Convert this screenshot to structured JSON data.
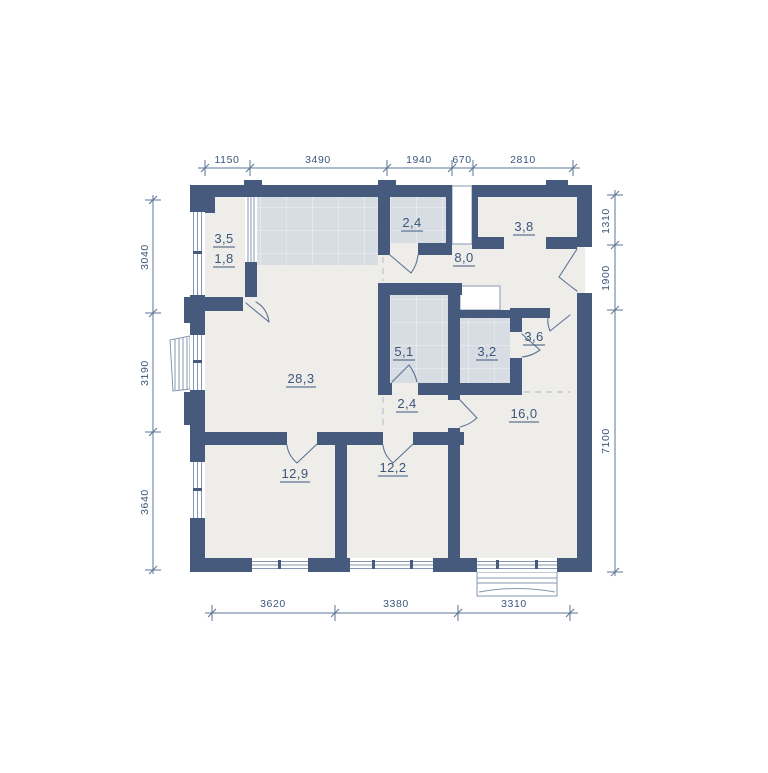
{
  "plan_title": "apartment-floor-plan",
  "colors": {
    "wall": "#455a7c",
    "floor": "#eeedea",
    "tile": "#d8dde4",
    "tile-line": "#e9ecf0",
    "ink": "#3a567a",
    "dim": "#5a7494",
    "frame": "#8597b0",
    "dash": "#b9c3d1",
    "bg": "#ffffff"
  },
  "rooms": {
    "loggia_total": "3,5",
    "loggia_reduced": "1,8",
    "wc": "2,4",
    "wardrobe": "3,8",
    "hallway": "8,0",
    "bathroom": "5,1",
    "shower_room": "3,2",
    "corridor": "3,6",
    "kitchen_living": "28,3",
    "inner_hall": "2,4",
    "bedroom_right": "16,0",
    "bedroom_left": "12,9",
    "bedroom_middle": "12,2"
  },
  "dimensions": {
    "top": [
      "1150",
      "3490",
      "1940",
      "670",
      "2810"
    ],
    "left": [
      "3040",
      "3190",
      "3640"
    ],
    "right": [
      "1310",
      "1900",
      "7100"
    ],
    "bottom": [
      "3620",
      "3380",
      "3310"
    ]
  }
}
